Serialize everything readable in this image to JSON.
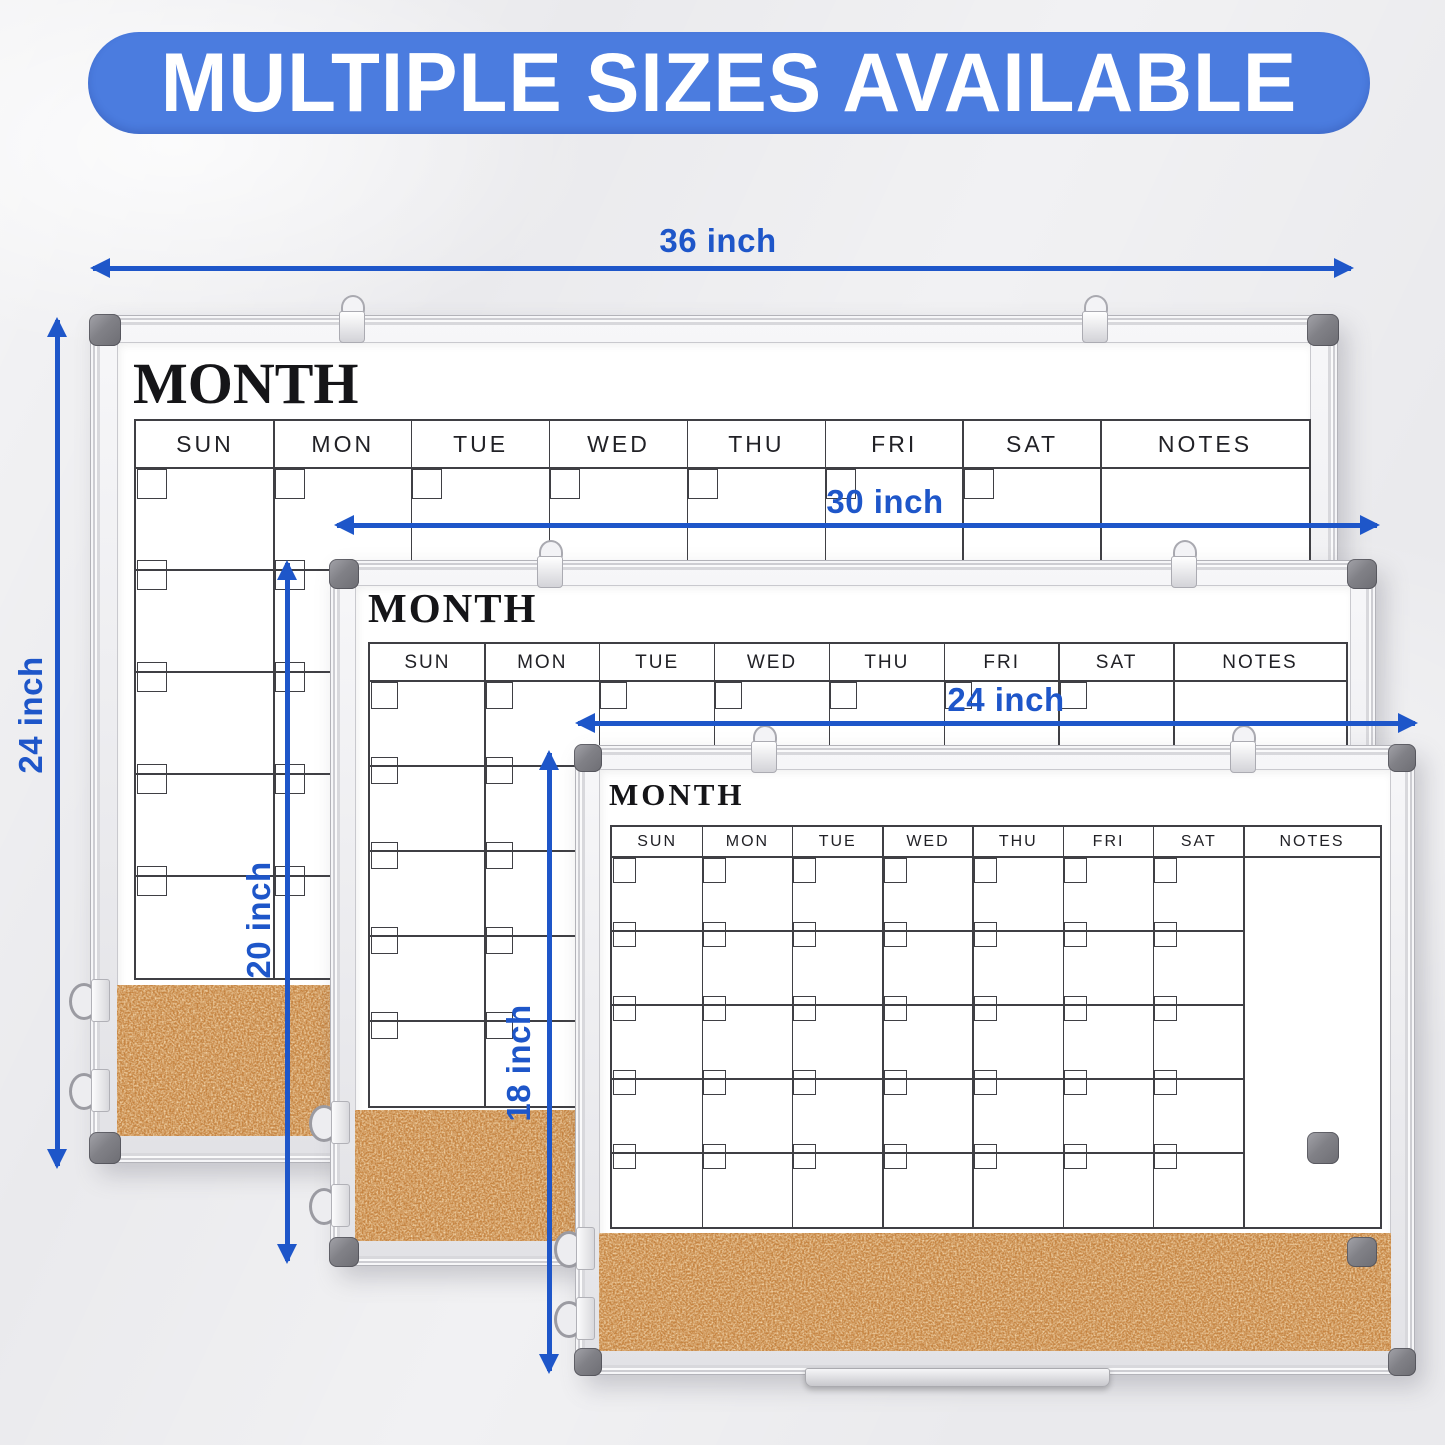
{
  "banner": {
    "text": "MULTIPLE SIZES AVAILABLE"
  },
  "dimension_labels": {
    "board_36_width": "36 inch",
    "board_36_height": "24 inch",
    "board_30_width": "30 inch",
    "board_30_height": "20 inch",
    "board_24_width": "24 inch",
    "board_24_height": "18 inch"
  },
  "boards": [
    {
      "name": "36x24-inch",
      "title": "MONTH",
      "day_headers": [
        "SUN",
        "MON",
        "TUE",
        "WED",
        "THU",
        "FRI",
        "SAT"
      ],
      "notes_header": "NOTES",
      "calendar_rows": 5,
      "has_cork_strip": true
    },
    {
      "name": "30x20-inch",
      "title": "MONTH",
      "day_headers": [
        "SUN",
        "MON",
        "TUE",
        "WED",
        "THU",
        "FRI",
        "SAT"
      ],
      "notes_header": "NOTES",
      "calendar_rows": 5,
      "has_cork_strip": true
    },
    {
      "name": "24x18-inch",
      "title": "MONTH",
      "day_headers": [
        "SUN",
        "MON",
        "TUE",
        "WED",
        "THU",
        "FRI",
        "SAT"
      ],
      "notes_header": "NOTES",
      "calendar_rows": 5,
      "has_cork_strip": true
    }
  ],
  "colors": {
    "banner_blue": "#4b7cdf",
    "dimension_blue": "#1e56c9",
    "cork_tan": "#c5823f",
    "frame_silver": "#e9e9ec",
    "corner_cap_gray": "#85858a",
    "grid_line": "#3f3f44",
    "background": "#eaeaed"
  }
}
